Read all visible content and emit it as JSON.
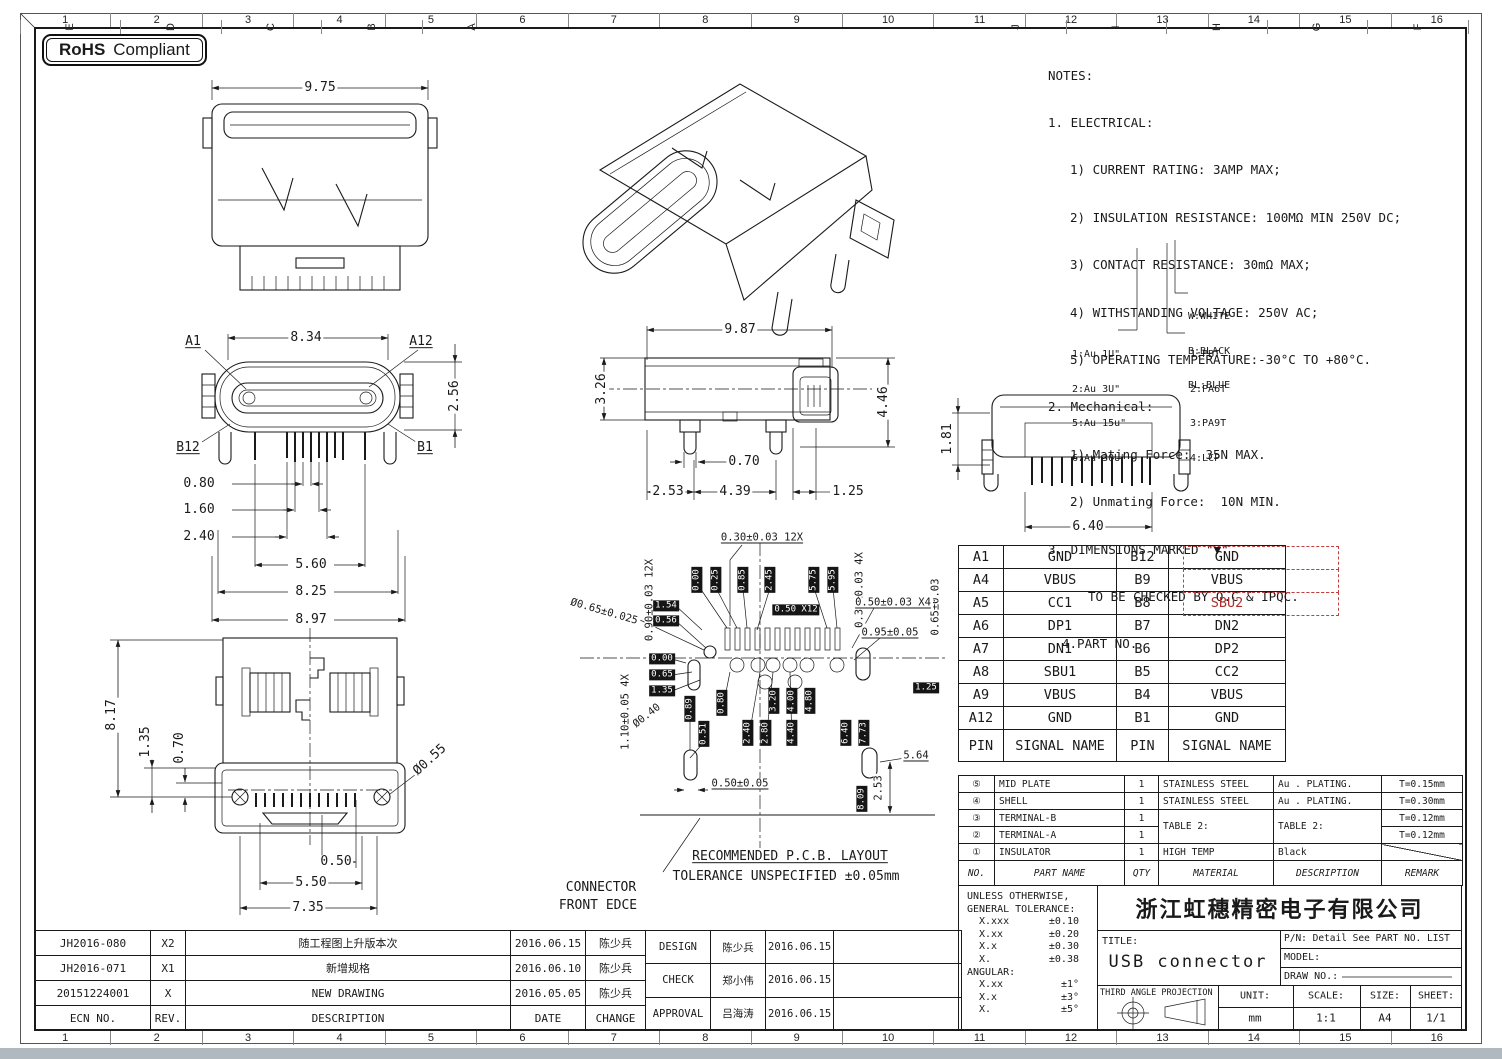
{
  "sheet": {
    "cols": [
      "1",
      "2",
      "3",
      "4",
      "5",
      "6",
      "7",
      "8",
      "9",
      "10",
      "11",
      "12",
      "13",
      "14",
      "15",
      "16"
    ],
    "rows": [
      "J",
      "I",
      "H",
      "G",
      "F",
      "E",
      "D",
      "C",
      "B",
      "A"
    ],
    "badge": {
      "bold": "RoHS",
      "text": "Compliant"
    }
  },
  "notes": {
    "lines": [
      "NOTES:",
      "1. ELECTRICAL:",
      "1) CURRENT RATING: 3AMP MAX;",
      "2) INSULATION RESISTANCE: 100MΩ MIN 250V DC;",
      "3) CONTACT RESISTANCE: 30mΩ MAX;",
      "4) WITHSTANDING VOLTAGE: 250V AC;",
      "5) OPERATING TEMPERATURE:-30°C TO +80°C.",
      "2. Mechanical:",
      "1) Mating Force:  35N MAX.",
      "2) Unmating Force:  10N MIN.",
      "3. DIMENSIONS MARKED \"▼\"",
      "TO BE CHECKED BY Q.C & IPQC.",
      "4.PART NO."
    ]
  },
  "callouts": {
    "colors": [
      "W:WHITE",
      "B:BLACK",
      "BL:BLUE"
    ],
    "plating": [
      "1:Au 1U\"",
      "2:Au 3U\"",
      "5:Au 15u\"",
      "6:Au 30U\""
    ],
    "resins": [
      "1:PBT",
      "2:PA6T",
      "3:PA9T",
      "4:LCP"
    ]
  },
  "dims": {
    "top": {
      "w": "9.75"
    },
    "front": {
      "w": "8.34",
      "h": "2.56",
      "a1": "A1",
      "a12": "A12",
      "b12": "B12",
      "b1": "B1",
      "p1": "0.80",
      "p2": "1.60",
      "p3": "2.40",
      "p4": "5.60",
      "p5": "8.25",
      "p6": "8.97"
    },
    "side": {
      "w": "9.87",
      "h1": "3.26",
      "h2": "4.46",
      "d1": "0.70",
      "d2": "2.53",
      "d3": "4.39",
      "d4": "1.25"
    },
    "rear": {
      "h": "1.81",
      "w": "6.40"
    },
    "bottom": {
      "h": "8.17",
      "d1": "1.35",
      "d2": "0.70",
      "hole": "Ø0.55",
      "p1": "0.50",
      "p2": "5.50",
      "p3": "7.35"
    },
    "pcb": {
      "top_pitch": "0.30±0.03 12X",
      "left_v": "0.90±0.03 12X",
      "right_v": "0.30±0.03 4X",
      "far_right_v": "0.65±0.03",
      "hole1": "Ø0.65±0.025",
      "hole2": "Ø0.40",
      "r1": "0.50±0.03 X4",
      "r2": "0.95±0.05",
      "v2": "1.10±0.05 4X",
      "b1": "0.50±0.05",
      "b2": "5.64",
      "b3": "2.53",
      "boxes": [
        "1.54",
        "0.56",
        "0.00",
        "0.65",
        "1.35",
        "1.25",
        "0.50 X12",
        "0.00",
        "0.25",
        "0.85",
        "2.45",
        "5.75",
        "5.95",
        "0.89",
        "0.80",
        "3.20",
        "4.00",
        "4.80",
        "0.51",
        "2.40",
        "2.80",
        "4.40",
        "6.40",
        "7.73",
        "8.09"
      ],
      "note1": "RECOMMENDED  P.C.B. LAYOUT",
      "note2": "TOLERANCE UNSPECIFIED ±0.05mm",
      "edge1": "CONNECTOR",
      "edge2": "FRONT EDCE"
    }
  },
  "pin_table": {
    "rows": [
      {
        "pa": "A1",
        "sa": "GND",
        "pb": "B12",
        "sb": "GND"
      },
      {
        "pa": "A4",
        "sa": "VBUS",
        "pb": "B9",
        "sb": "VBUS"
      },
      {
        "pa": "A5",
        "sa": "CC1",
        "pb": "B8",
        "sb": "SBU2"
      },
      {
        "pa": "A6",
        "sa": "DP1",
        "pb": "B7",
        "sb": "DN2"
      },
      {
        "pa": "A7",
        "sa": "DN1",
        "pb": "B6",
        "sb": "DP2"
      },
      {
        "pa": "A8",
        "sa": "SBU1",
        "pb": "B5",
        "sb": "CC2"
      },
      {
        "pa": "A9",
        "sa": "VBUS",
        "pb": "B4",
        "sb": "VBUS"
      },
      {
        "pa": "A12",
        "sa": "GND",
        "pb": "B1",
        "sb": "GND"
      },
      {
        "pa": "PIN",
        "sa": "SIGNAL NAME",
        "pb": "PIN",
        "sb": "SIGNAL NAME"
      }
    ]
  },
  "parts_table": {
    "rows": [
      {
        "no": "⑤",
        "name": "MID PLATE",
        "qty": "1",
        "mat": "STAINLESS STEEL",
        "desc": "Au . PLATING.",
        "remark": "T=0.15mm"
      },
      {
        "no": "④",
        "name": "SHELL",
        "qty": "1",
        "mat": "STAINLESS STEEL",
        "desc": "Au . PLATING.",
        "remark": "T=0.30mm"
      },
      {
        "no": "③",
        "name": "TERMINAL-B",
        "qty": "1",
        "mat": "TABLE 2:",
        "desc": "TABLE 2:",
        "remark": "T=0.12mm"
      },
      {
        "no": "②",
        "name": "TERMINAL-A",
        "qty": "1",
        "mat": "",
        "desc": "",
        "remark": "T=0.12mm"
      },
      {
        "no": "①",
        "name": "INSULATOR",
        "qty": "1",
        "mat": "HIGH TEMP",
        "desc": "Black",
        "remark": ""
      }
    ],
    "header": {
      "no": "NO.",
      "name": "PART NAME",
      "qty": "QTY",
      "mat": "MATERIAL",
      "desc": "DESCRIPTION",
      "remark": "REMARK"
    }
  },
  "tolerance": {
    "l1": "UNLESS OTHERWISE,",
    "l2": "GENERAL TOLERANCE:",
    "rows": [
      [
        "X.xxx",
        "±0.10"
      ],
      [
        "X.xx",
        "±0.20"
      ],
      [
        "X.x",
        "±0.30"
      ],
      [
        "X.",
        "±0.38"
      ]
    ],
    "angular": "ANGULAR:",
    "arows": [
      [
        "X.xx",
        "±1°"
      ],
      [
        "X.x",
        "±3°"
      ],
      [
        "X.",
        "±5°"
      ]
    ]
  },
  "title_block": {
    "company": "浙江虹穗精密电子有限公司",
    "title_label": "TITLE:",
    "title": "USB connector",
    "pn": "P/N: Detail See PART NO. LIST",
    "model_label": "MODEL:",
    "draw_label": "DRAW NO.:",
    "projection": "THIRD ANGLE PROJECTION",
    "unit_label": "UNIT:",
    "unit": "mm",
    "scale_label": "SCALE:",
    "scale": "1:1",
    "size_label": "SIZE:",
    "size": "A4",
    "sheet_label": "SHEET:",
    "sheet": "1/1"
  },
  "revisions": {
    "rows": [
      {
        "ecn": "JH2016-080",
        "rev": "X2",
        "desc": "随工程图上升版本次",
        "date": "2016.06.15",
        "change": "陈少兵"
      },
      {
        "ecn": "JH2016-071",
        "rev": "X1",
        "desc": "新增规格",
        "date": "2016.06.10",
        "change": "陈少兵"
      },
      {
        "ecn": "20151224001",
        "rev": "X",
        "desc": "NEW DRAWING",
        "date": "2016.05.05",
        "change": "陈少兵"
      },
      {
        "ecn": "ECN NO.",
        "rev": "REV.",
        "desc": "DESCRIPTION",
        "date": "DATE",
        "change": "CHANGE"
      }
    ]
  },
  "approvals": {
    "rows": [
      {
        "role": "DESIGN",
        "name": "陈少兵",
        "date": "2016.06.15"
      },
      {
        "role": "CHECK",
        "name": "郑小伟",
        "date": "2016.06.15"
      },
      {
        "role": "APPROVAL",
        "name": "吕海涛",
        "date": "2016.06.15"
      }
    ]
  }
}
